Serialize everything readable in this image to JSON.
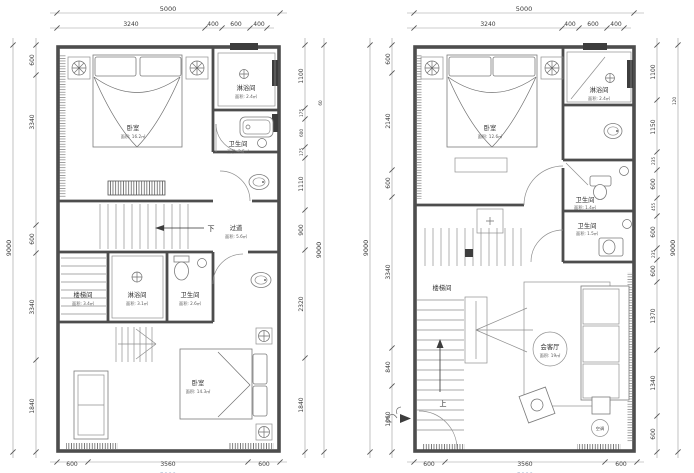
{
  "page": {
    "background": "#ffffff",
    "line_color": "#4d4d4d",
    "dim_text_color": "#3a3a3a",
    "faded_blue": "#8fa6c2"
  },
  "plans": [
    {
      "id": "left-floor-plan",
      "dims": {
        "top_overall": "5000",
        "top_chain": [
          "3240",
          "400",
          "600",
          "400"
        ],
        "left_overall": "9000",
        "left_chain": [
          "600",
          "3340",
          "600",
          "3340",
          "1840"
        ],
        "right_chain": [
          "1100",
          "175",
          "600",
          "175",
          "1110",
          "900",
          "2320",
          "1840"
        ],
        "right_outer": [
          "60",
          "9000"
        ],
        "bottom_chain": [
          "600",
          "3560",
          "600"
        ],
        "bottom_overall": "5000"
      },
      "rooms": [
        {
          "label": "卧室",
          "area": "面积: 16.2㎡"
        },
        {
          "label": "淋浴间",
          "area": "面积: 2.4㎡"
        },
        {
          "label": "卫生间",
          "area": "面积: 2.5㎡"
        },
        {
          "label": "过道",
          "area": "面积: 5.6㎡"
        },
        {
          "label": "楼梯间",
          "area": "面积: 3.4㎡"
        },
        {
          "label": "淋浴间",
          "area": "面积: 3.1㎡"
        },
        {
          "label": "卫生间",
          "area": "面积: 2.6㎡"
        },
        {
          "label": "卧室",
          "area": "面积: 14.3㎡"
        }
      ],
      "notes": {
        "down": "下"
      }
    },
    {
      "id": "right-floor-plan",
      "dims": {
        "top_overall": "5000",
        "top_chain": [
          "3240",
          "400",
          "600",
          "400"
        ],
        "left_overall": "9000",
        "left_chain": [
          "600",
          "2140",
          "600",
          "3340",
          "840",
          "1060"
        ],
        "right_chain": [
          "1100",
          "1150",
          "235",
          "600",
          "455",
          "600",
          "235",
          "600",
          "1370",
          "1340",
          "600"
        ],
        "right_outer": [
          "120",
          "9000"
        ],
        "bottom_chain": [
          "600",
          "3560",
          "600"
        ],
        "bottom_overall": "5000"
      },
      "rooms": [
        {
          "label": "卧室",
          "area": "面积: 12.6㎡"
        },
        {
          "label": "淋浴间",
          "area": "面积: 2.4㎡"
        },
        {
          "label": "卫生间",
          "area": "面积: 1.4㎡"
        },
        {
          "label": "卫生间",
          "area": "面积: 1.5㎡"
        },
        {
          "label": "楼梯间",
          "area": ""
        },
        {
          "label": "会客厅",
          "area": "面积: 19㎡"
        }
      ],
      "notes": {
        "up": "上",
        "ac": "空调"
      }
    }
  ]
}
